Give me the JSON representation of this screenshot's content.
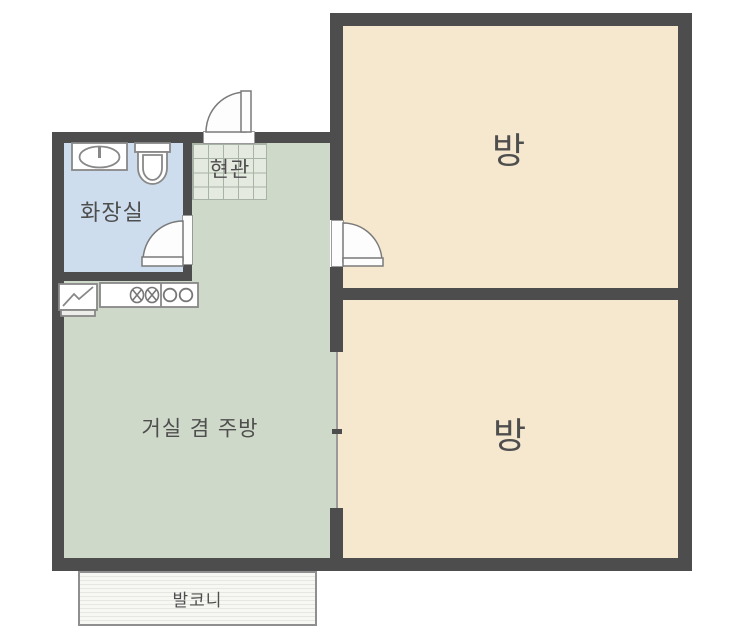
{
  "floorplan": {
    "kind": "apartment-floor-plan",
    "rooms": {
      "bedroom_top": {
        "label": "방"
      },
      "bedroom_bottom": {
        "label": "방"
      },
      "living_kitchen": {
        "label": "거실 겸 주방"
      },
      "bathroom": {
        "label": "화장실"
      },
      "entrance": {
        "label": "현관"
      },
      "balcony": {
        "label": "발코니"
      }
    },
    "colors": {
      "wall": "#4d4d4d",
      "bedroom_fill": "#f6e8ce",
      "living_fill": "#cfd9ca",
      "bathroom_fill": "#cddded",
      "entrance_tile_fill": "#e4eadf",
      "tile_grid_line": "#a8b3a5",
      "balcony_fill": "#f6f6f3",
      "door_fill": "#fdfdfd",
      "fixture_stroke": "#888888",
      "label_text": "#4e4e4e"
    },
    "icons": {
      "bathroom": [
        "washbasin-icon",
        "toilet-icon"
      ],
      "kitchen": [
        "refrigerator-icon",
        "stove-burners-icon",
        "double-sink-icon"
      ],
      "doors": [
        "entrance-door-swing-icon",
        "bathroom-door-swing-icon",
        "bedroom-door-swing-icon",
        "open-partition-line"
      ]
    }
  }
}
